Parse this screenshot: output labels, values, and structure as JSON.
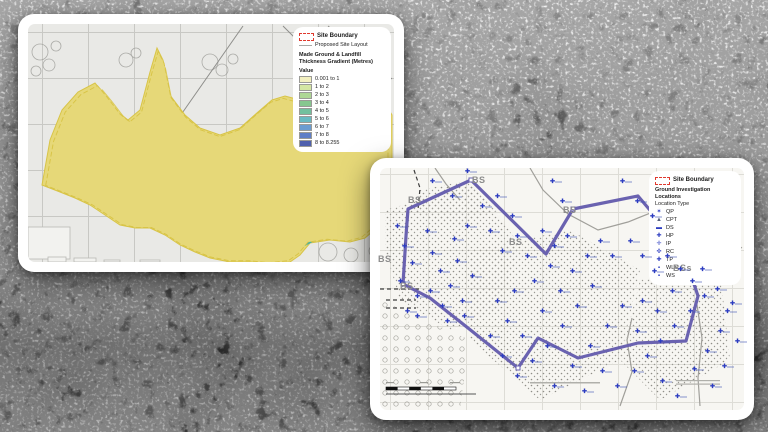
{
  "left_panel": {
    "legend": {
      "site_boundary": "Site Boundary",
      "proposed_layout": "Proposed Site Layout",
      "gradient_title_1": "Made Ground & Landfill",
      "gradient_title_2": "Thickness Gradient (Metres)",
      "value_heading": "Value",
      "boundary_color": "#e0392e",
      "classes": [
        {
          "label": "0.001 to 1",
          "color": "#f3f0c0"
        },
        {
          "label": "1 to 2",
          "color": "#d4e6a3"
        },
        {
          "label": "2 to 3",
          "color": "#aed795"
        },
        {
          "label": "3 to 4",
          "color": "#86c78f"
        },
        {
          "label": "4 to 5",
          "color": "#72c09e"
        },
        {
          "label": "5 to 6",
          "color": "#69bac2"
        },
        {
          "label": "6 to 7",
          "color": "#6b9cd1"
        },
        {
          "label": "7 to 8",
          "color": "#5f7ec6"
        },
        {
          "label": "8 to 8.255",
          "color": "#4f60ad"
        }
      ]
    }
  },
  "right_panel": {
    "legend": {
      "site_boundary": "Site Boundary",
      "subtitle": "Ground Investigation Locations",
      "type_heading": "Location Type",
      "boundary_color": "#e0392e",
      "marker_color": "#2c3cc0",
      "types": [
        {
          "label": "QP",
          "glyph": "✶",
          "color": "#2c3cc0"
        },
        {
          "label": "CPT",
          "glyph": "▲",
          "color": "#55607a"
        },
        {
          "label": "DS",
          "glyph": "▬",
          "color": "#2c3cc0"
        },
        {
          "label": "HP",
          "glyph": "✚",
          "color": "#2c3cc0"
        },
        {
          "label": "IP",
          "glyph": "✛",
          "color": "#2c3cc0"
        },
        {
          "label": "RC",
          "glyph": "✜",
          "color": "#2c3cc0"
        },
        {
          "label": "TP",
          "glyph": "✚",
          "color": "#2c3cc0"
        },
        {
          "label": "WLS",
          "glyph": "▪",
          "color": "#2c3cc0"
        },
        {
          "label": "WS",
          "glyph": "▪",
          "color": "#2c3cc0"
        }
      ]
    },
    "map": {
      "site_boundary_color": "#6a62b0",
      "bs_labels": [
        {
          "x": 472,
          "y": 176,
          "text": "BS"
        },
        {
          "x": 408,
          "y": 196,
          "text": "BS"
        },
        {
          "x": 563,
          "y": 206,
          "text": "BS"
        },
        {
          "x": 509,
          "y": 238,
          "text": "BS"
        },
        {
          "x": 378,
          "y": 255,
          "text": "BS"
        },
        {
          "x": 400,
          "y": 282,
          "text": "BS"
        },
        {
          "x": 673,
          "y": 264,
          "text": "BSs"
        }
      ],
      "markers": [
        [
          395,
          225
        ],
        [
          402,
          245
        ],
        [
          410,
          262
        ],
        [
          398,
          280
        ],
        [
          415,
          295
        ],
        [
          425,
          230
        ],
        [
          430,
          252
        ],
        [
          438,
          270
        ],
        [
          428,
          290
        ],
        [
          440,
          305
        ],
        [
          452,
          238
        ],
        [
          455,
          260
        ],
        [
          448,
          285
        ],
        [
          460,
          300
        ],
        [
          465,
          225
        ],
        [
          470,
          275
        ],
        [
          462,
          315
        ],
        [
          415,
          315
        ],
        [
          405,
          310
        ],
        [
          445,
          320
        ],
        [
          480,
          205
        ],
        [
          495,
          195
        ],
        [
          510,
          215
        ],
        [
          488,
          230
        ],
        [
          500,
          250
        ],
        [
          515,
          235
        ],
        [
          525,
          255
        ],
        [
          540,
          230
        ],
        [
          552,
          245
        ],
        [
          565,
          235
        ],
        [
          548,
          265
        ],
        [
          532,
          280
        ],
        [
          512,
          290
        ],
        [
          495,
          300
        ],
        [
          505,
          320
        ],
        [
          520,
          335
        ],
        [
          540,
          310
        ],
        [
          558,
          290
        ],
        [
          570,
          270
        ],
        [
          585,
          255
        ],
        [
          598,
          240
        ],
        [
          610,
          255
        ],
        [
          590,
          285
        ],
        [
          575,
          305
        ],
        [
          560,
          325
        ],
        [
          545,
          345
        ],
        [
          530,
          360
        ],
        [
          515,
          375
        ],
        [
          500,
          355
        ],
        [
          488,
          335
        ],
        [
          552,
          385
        ],
        [
          570,
          365
        ],
        [
          588,
          345
        ],
        [
          605,
          325
        ],
        [
          620,
          305
        ],
        [
          600,
          370
        ],
        [
          615,
          385
        ],
        [
          582,
          390
        ],
        [
          628,
          240
        ],
        [
          640,
          255
        ],
        [
          652,
          270
        ],
        [
          665,
          255
        ],
        [
          678,
          268
        ],
        [
          690,
          280
        ],
        [
          702,
          295
        ],
        [
          688,
          310
        ],
        [
          672,
          325
        ],
        [
          658,
          340
        ],
        [
          645,
          355
        ],
        [
          632,
          370
        ],
        [
          660,
          380
        ],
        [
          675,
          395
        ],
        [
          692,
          368
        ],
        [
          705,
          350
        ],
        [
          718,
          330
        ],
        [
          725,
          310
        ],
        [
          710,
          385
        ],
        [
          722,
          365
        ],
        [
          735,
          340
        ],
        [
          640,
          300
        ],
        [
          655,
          310
        ],
        [
          670,
          290
        ],
        [
          635,
          330
        ],
        [
          430,
          180
        ],
        [
          450,
          195
        ],
        [
          465,
          170
        ],
        [
          550,
          180
        ],
        [
          560,
          200
        ],
        [
          620,
          180
        ],
        [
          635,
          200
        ],
        [
          650,
          215
        ],
        [
          700,
          268
        ],
        [
          715,
          288
        ],
        [
          730,
          302
        ]
      ]
    }
  }
}
